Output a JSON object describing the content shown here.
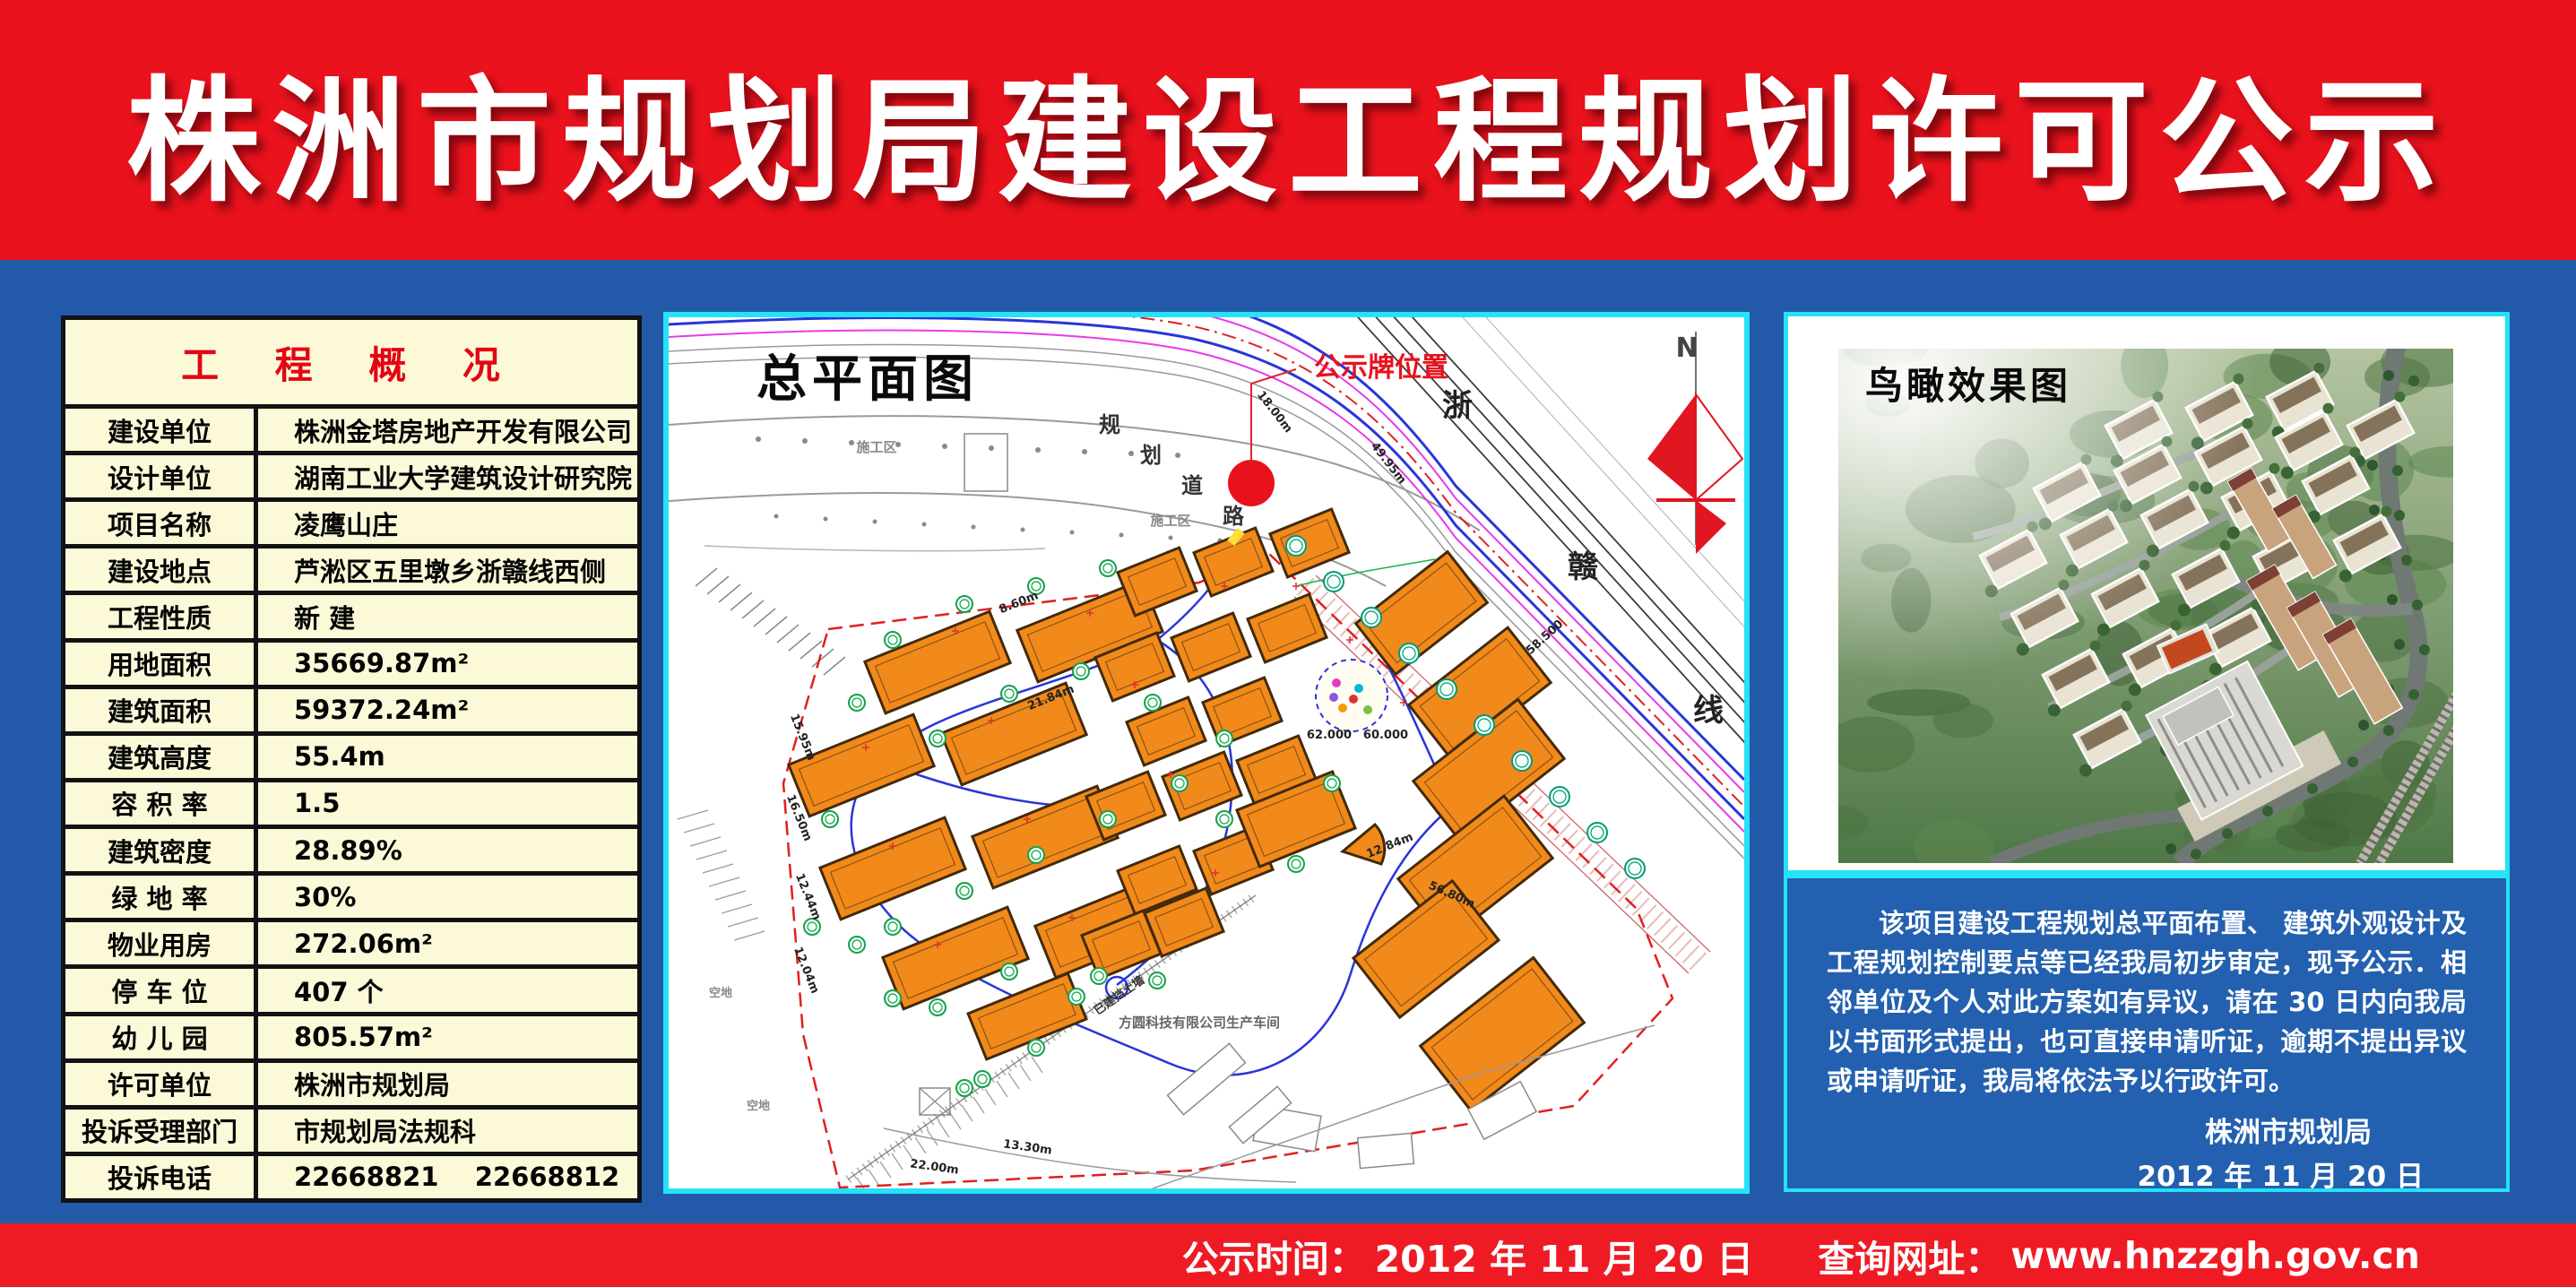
{
  "header": {
    "title": "株洲市规划局建设工程规划许可公示"
  },
  "project_table": {
    "title": "工 程 概 况",
    "rows": [
      {
        "label": "建设单位",
        "value": "株洲金塔房地产开发有限公司"
      },
      {
        "label": "设计单位",
        "value": "湖南工业大学建筑设计研究院"
      },
      {
        "label": "项目名称",
        "value": "凌鹰山庄"
      },
      {
        "label": "建设地点",
        "value": "芦淞区五里墩乡浙赣线西侧"
      },
      {
        "label": "工程性质",
        "value": "新 建"
      },
      {
        "label": "用地面积",
        "value": "35669.87m²"
      },
      {
        "label": "建筑面积",
        "value": "59372.24m²"
      },
      {
        "label": "建筑高度",
        "value": "55.4m"
      },
      {
        "label": "容 积 率",
        "value": "1.5"
      },
      {
        "label": "建筑密度",
        "value": "28.89%"
      },
      {
        "label": "绿 地 率",
        "value": "30%"
      },
      {
        "label": "物业用房",
        "value": "272.06m²"
      },
      {
        "label": "停 车 位",
        "value": "407 个"
      },
      {
        "label": "幼 儿 园",
        "value": "805.57m²"
      },
      {
        "label": "许可单位",
        "value": "株洲市规划局"
      },
      {
        "label": "投诉受理部门",
        "value": "市规划局法规科"
      },
      {
        "label": "投诉电话",
        "value": "22668821    22668812"
      }
    ]
  },
  "site_plan": {
    "title": "总平面图",
    "notice_board_label": "公示牌位置",
    "road_label_chars": [
      "规",
      "划",
      "道",
      "路"
    ],
    "railway_label_chars": [
      "浙",
      "赣",
      "线"
    ],
    "north_label": "N",
    "construction_label": "施工区",
    "factory_label": "方圆科技有限公司生产车间",
    "retaining_wall_label": "已建挡土墙",
    "vacant_label": "空地",
    "dimension_labels": [
      "18.00m",
      "60.000",
      "62.000",
      "58.500",
      "56.80m",
      "49.95m",
      "12.44m",
      "16.50m",
      "21.84m",
      "8.60m",
      "13.30m",
      "22.00m",
      "12.84m",
      "15.95m",
      "12.04m"
    ]
  },
  "render_panel": {
    "title": "鸟瞰效果图",
    "notice_text": "该项目建设工程规划总平面布置、 建筑外观设计及工程规划控制要点等已经我局初步审定，现予公示．相邻单位及个人对此方案如有异议，请在 30 日内向我局以书面形式提出，也可直接申请听证，逾期不提出异议或申请听证，我局将依法予以行政许可。",
    "signature": "株洲市规划局",
    "date": "2012 年 11 月 20 日"
  },
  "footer": {
    "publish_time_label": "公示时间：",
    "publish_time": "2012 年 11 月 20 日",
    "website_label": "查询网址：",
    "website": "www.hnzzgh.gov.cn"
  },
  "colors": {
    "header_red": "#e9121d",
    "footer_red": "#ee1b24",
    "body_blue": "#2259a9",
    "border_cyan": "#25e2f6",
    "table_bg": "#fcf9d9",
    "table_title_red": "#e30514",
    "building_orange": "#f18a1b"
  }
}
